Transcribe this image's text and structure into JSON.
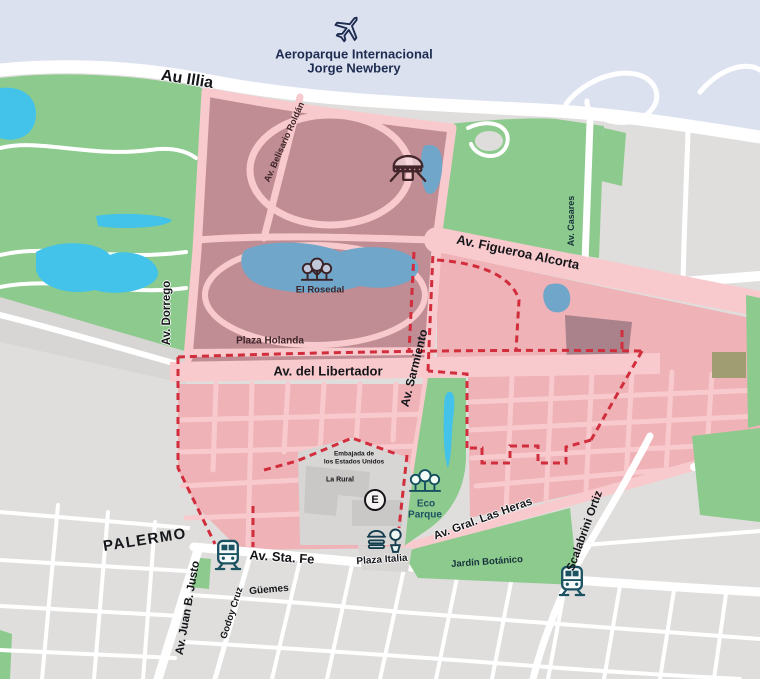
{
  "map": {
    "neighborhood": "PALERMO",
    "airport": {
      "line1": "Aeroparque Internacional",
      "line2": "Jorge Newbery"
    },
    "roads": {
      "au_illia": "Au Illia",
      "belisario_roldan": "Av. Belisario Roldán",
      "figueroa_alcorta": "Av. Figueroa Alcorta",
      "casares": "Av. Casares",
      "dorrego": "Av. Dorrego",
      "del_libertador": "Av. del Libertador",
      "sarmiento": "Av. Sarmiento",
      "gral_las_heras": "Av. Gral. Las Heras",
      "santa_fe": "Av. Sta. Fe",
      "juan_b_justo": "Av. Juan B. Justo",
      "scalabrini_ortiz": "Scalabrini Ortiz",
      "guemes": "Güemes",
      "godoy_cruz": "Godoy Cruz"
    },
    "places": {
      "el_rosedal": "El Rosedal",
      "plaza_holanda": "Plaza Holanda",
      "eco_parque_line1": "Eco",
      "eco_parque_line2": "Parque",
      "jardin_botanico": "Jardín Botánico",
      "la_rural": "La Rural",
      "embajada_line1": "Embajada de",
      "embajada_line2": "los Estados Unidos",
      "plaza_italia": "Plaza Italia",
      "subway_e_badge": "E"
    },
    "colors": {
      "water": "#dce1f0",
      "park-green": "#8dca8d",
      "lake-cyan": "#43c2ea",
      "lake-steel": "#6fa6c9",
      "highlight-mauve": "#bf8d93",
      "highlight-mauve-dark": "#aa828b",
      "highlight-block-pink": "#efb2b7",
      "highlight-road-pink": "#f8cacd",
      "boundary-red": "#d22d3c",
      "land-gray": "#dfdedc",
      "building-gray": "#c9c8c6",
      "label-dark": "#15161a",
      "icon-teal": "#1c5262",
      "label-navy": "#1d2c50",
      "label-maroon": "#3d2428"
    }
  }
}
